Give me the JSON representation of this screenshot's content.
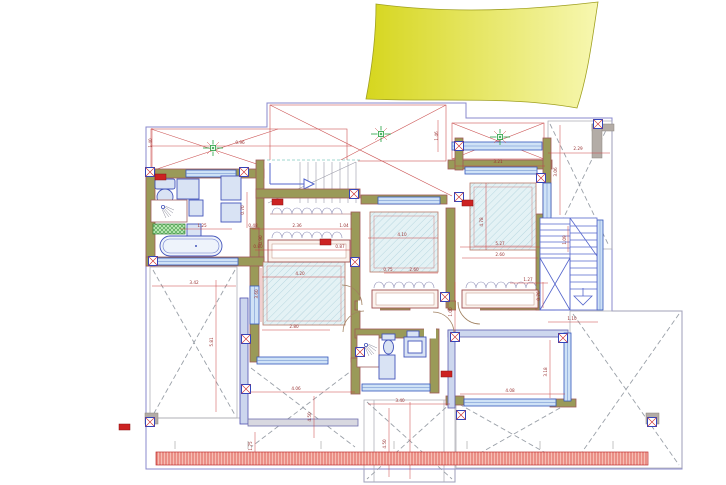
{
  "canvas": {
    "width": 726,
    "height": 485,
    "background": "#ffffff"
  },
  "colors": {
    "wall_fill": "#9a9a58",
    "wall_edge": "#a05858",
    "window_fill": "#cfe2f6",
    "window_edge": "#3355bb",
    "boundary_blue": "#8888cc",
    "roof_line_red": "#cc5555",
    "terrace_dash_gray": "#9aa0a8",
    "dim_line_red": "#cc4444",
    "dim_text": "#993333",
    "furniture_blue": "#4455bb",
    "furniture_fill": "#d9e3f4",
    "bed_fill": "#e4f2f5",
    "bed_hatch": "#a6ccd8",
    "green_symbol": "#22a040",
    "stairs_blue": "#5566cc",
    "canopy_yellow_dark": "#d6d61e",
    "canopy_yellow_light": "#f7f7b0",
    "louver_red": "#d84840",
    "tag_red": "#cc2222",
    "column_gray": "#b3aca6"
  },
  "symbols": [
    "ceiling-light-icon",
    "wall-connector-icon",
    "shower-head-icon",
    "toilet-icon",
    "bathtub-icon",
    "washbasin-icon",
    "wardrobe-hangers-icon",
    "stair-direction-arrow-icon",
    "stair-down-arrow-icon",
    "door-swing-arc",
    "red-revision-tag"
  ],
  "dimension_labels": [
    {
      "t": "1.40",
      "x": 152,
      "y": 143,
      "r": 1
    },
    {
      "t": "0.96",
      "x": 240,
      "y": 144
    },
    {
      "t": "1.46",
      "x": 438,
      "y": 136,
      "r": 1
    },
    {
      "t": "3.21",
      "x": 498,
      "y": 163
    },
    {
      "t": "2.29",
      "x": 578,
      "y": 150
    },
    {
      "t": "3.06",
      "x": 557,
      "y": 172,
      "r": 1
    },
    {
      "t": "4.78",
      "x": 483,
      "y": 222,
      "r": 1
    },
    {
      "t": "5.27",
      "x": 500,
      "y": 245
    },
    {
      "t": "2.60",
      "x": 500,
      "y": 256
    },
    {
      "t": "1.27",
      "x": 528,
      "y": 281
    },
    {
      "t": "0.76",
      "x": 540,
      "y": 296,
      "r": 1
    },
    {
      "t": "1.10",
      "x": 572,
      "y": 320
    },
    {
      "t": "1.09",
      "x": 566,
      "y": 240,
      "r": 1
    },
    {
      "t": "4.10",
      "x": 402,
      "y": 236
    },
    {
      "t": "0.75",
      "x": 388,
      "y": 271
    },
    {
      "t": "2.60",
      "x": 414,
      "y": 271
    },
    {
      "t": "0.48",
      "x": 253,
      "y": 227
    },
    {
      "t": "2.36",
      "x": 297,
      "y": 227
    },
    {
      "t": "1.04",
      "x": 344,
      "y": 227
    },
    {
      "t": "0.90",
      "x": 262,
      "y": 240,
      "r": 1
    },
    {
      "t": "0.80",
      "x": 258,
      "y": 248
    },
    {
      "t": "0.87",
      "x": 340,
      "y": 248
    },
    {
      "t": "4.20",
      "x": 300,
      "y": 275
    },
    {
      "t": "3.60",
      "x": 258,
      "y": 294,
      "r": 1
    },
    {
      "t": "2.80",
      "x": 294,
      "y": 328
    },
    {
      "t": "0.70",
      "x": 244,
      "y": 210,
      "r": 1
    },
    {
      "t": "1.25",
      "x": 202,
      "y": 227
    },
    {
      "t": "3.42",
      "x": 194,
      "y": 284
    },
    {
      "t": "5.81",
      "x": 213,
      "y": 342,
      "r": 1
    },
    {
      "t": "1.00",
      "x": 452,
      "y": 312,
      "r": 1
    },
    {
      "t": "4.06",
      "x": 296,
      "y": 390
    },
    {
      "t": "4.50",
      "x": 311,
      "y": 417,
      "r": 1
    },
    {
      "t": "3.40",
      "x": 400,
      "y": 402
    },
    {
      "t": "4.50",
      "x": 386,
      "y": 444,
      "r": 1
    },
    {
      "t": "4.08",
      "x": 510,
      "y": 392
    },
    {
      "t": "3.18",
      "x": 547,
      "y": 372,
      "r": 1
    },
    {
      "t": "1.75",
      "x": 252,
      "y": 446,
      "r": 1
    }
  ]
}
